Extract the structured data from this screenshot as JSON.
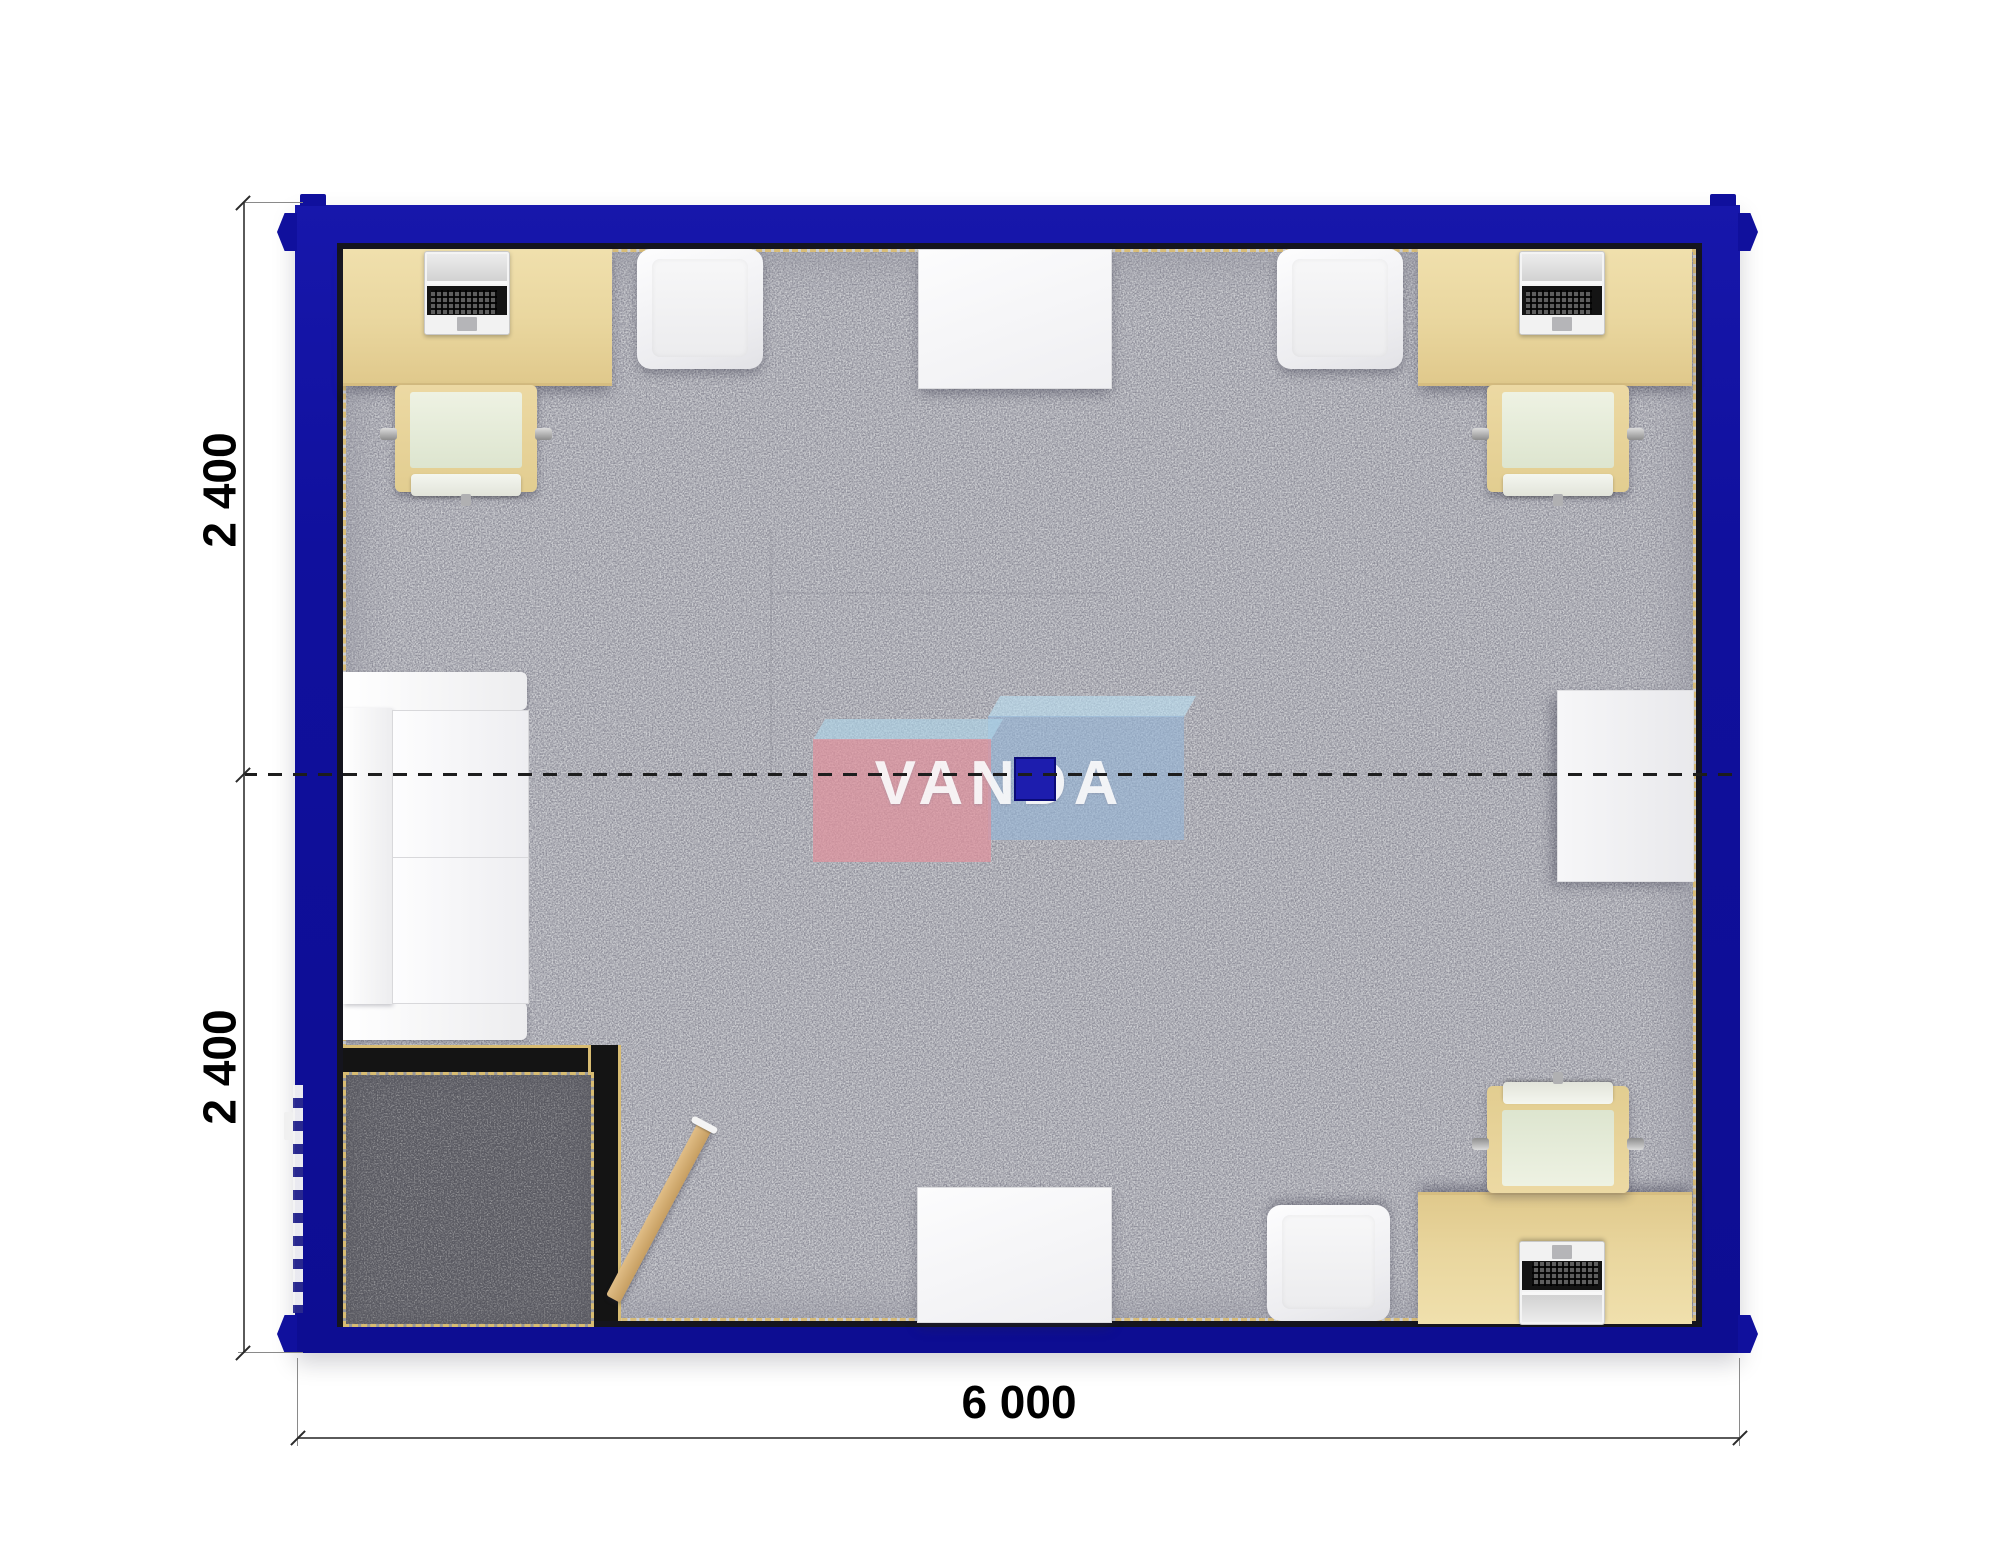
{
  "plan": {
    "title": "office container floor plan (top view)",
    "watermark": {
      "text": "VANDA",
      "pink_block": "#e0929c",
      "blue_block": "#94b5d6"
    },
    "dimensions": {
      "left_top": "2 400",
      "left_bottom": "2 400",
      "bottom": "6 000"
    },
    "colors": {
      "wall": "#10109d",
      "inner_wall_line": "#15151e",
      "carpet": "#cdced2",
      "vestibule_carpet": "#98989b",
      "trim_gold": "#d9bd77",
      "desk": "#e9d69e",
      "door": "#d2a96e",
      "furniture_white": "#f2f2f4",
      "floor_box": "#1d1dae"
    },
    "inventory": {
      "desks_with_laptops": 3,
      "task_chairs": 3,
      "armchairs": 3,
      "white_tables": 2,
      "sofas": 1,
      "side_cabinets": 1,
      "entry_vestibules": 1,
      "doors": 1,
      "floor_boxes": 1
    }
  }
}
